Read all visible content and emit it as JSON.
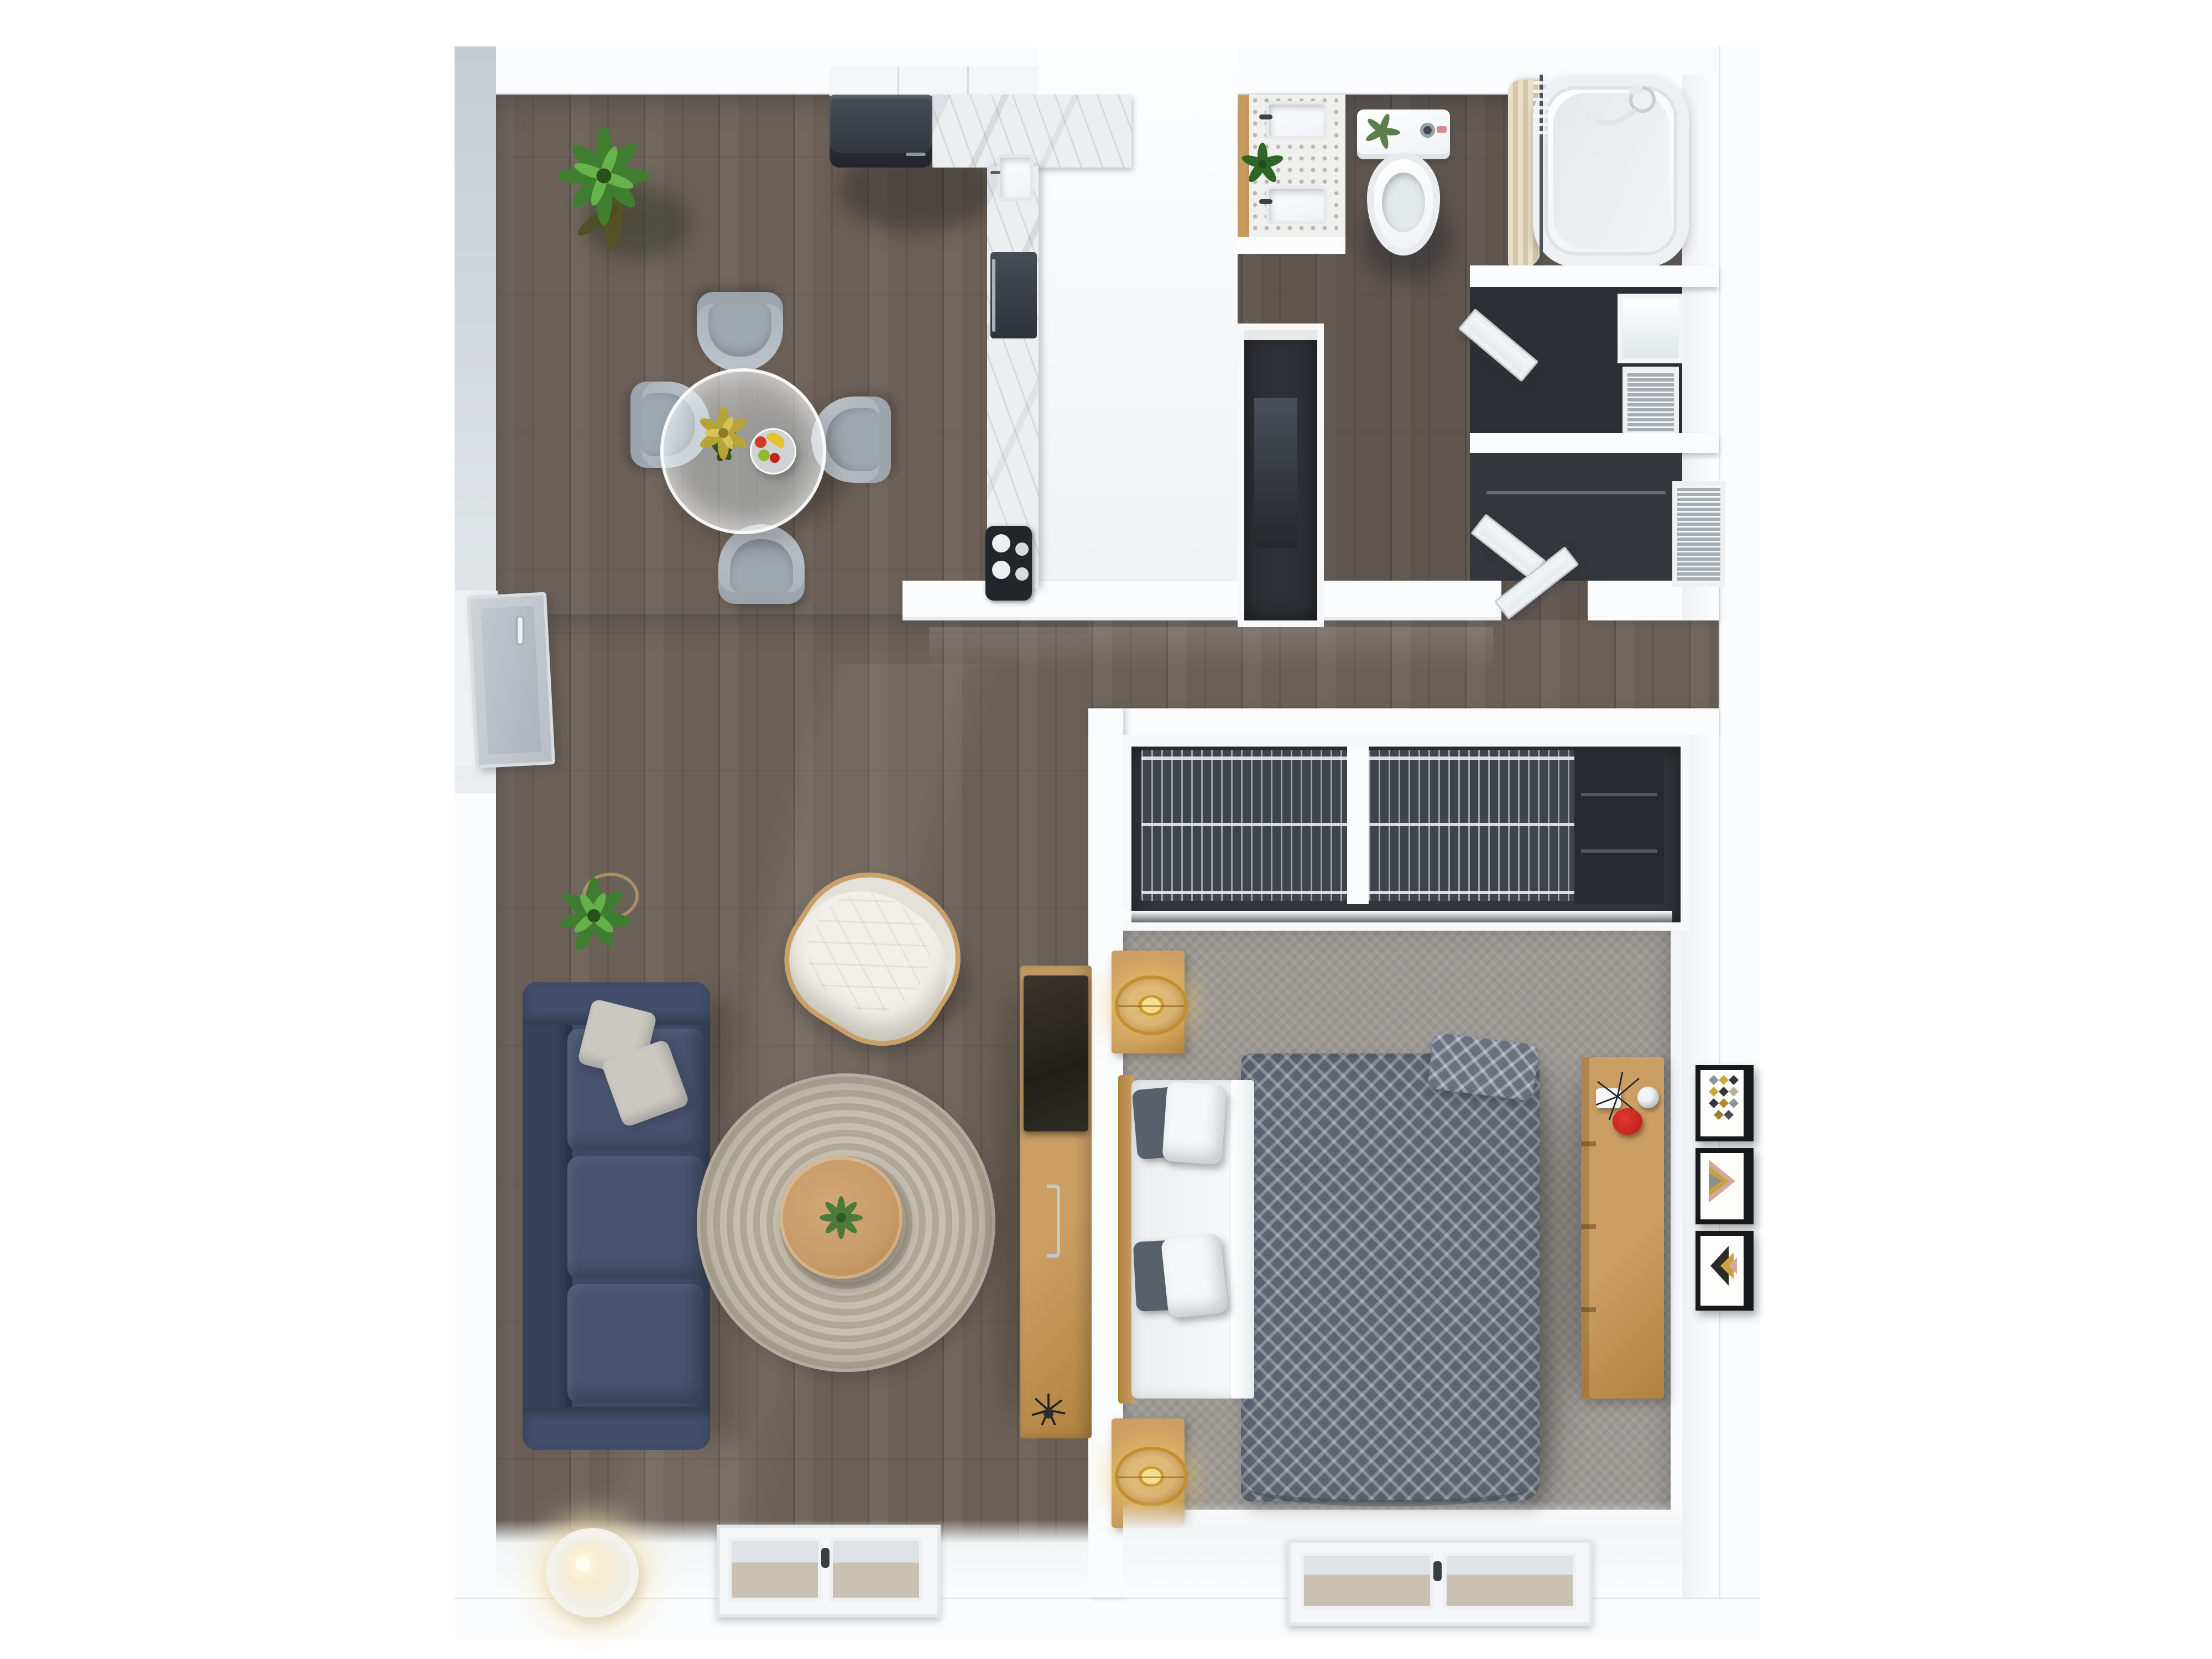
{
  "scene": {
    "type": "floor-plan-3d-top-view",
    "description": "Photorealistic top-down 3D render of a one-bedroom apartment floor plan on a white background",
    "background": "#ffffff"
  },
  "colors": {
    "wall": "#fafcfd",
    "wood": "#6b6057",
    "bath-dim": "rgba(28,30,38,0.16)",
    "carpet": "#9c9995",
    "marble": "#eceef0",
    "grid-door": "#3f444b",
    "blinds": "#cdd3d8",
    "glass-ground": "#c9c1b1",
    "navy": "#3e4a63",
    "navy-light": "#47536f",
    "pillow": "#cbc8c2",
    "oak": "#cb9f64",
    "oak-dark": "#b0823f",
    "duvet": "#5e6572",
    "gold": "#d9a43a",
    "red-accent": "#c5251e",
    "rug-light": "#c7bfb0",
    "rug-dark": "#b0a795",
    "table-wood": "#c времени",
    "tablewood": "#c79a67",
    "plant-green": "#4b8a38",
    "plant-dark": "#2e5d24",
    "appliance": "#34383e",
    "white-goods": "#fafbfc",
    "curtain": "#ded3bb",
    "door-gray": "#b6bcc2"
  },
  "rooms": [
    {
      "name": "living-dining",
      "floor": "dark wood planks",
      "items": [
        "large-potted-plant",
        "round-glass-dining-table",
        "dining-chairs x4",
        "flower-vase",
        "fruit-bowl",
        "navy-sofa",
        "throw-pillows x2",
        "small-potted-plant",
        "round-jute-rug",
        "round-wood-coffee-table",
        "white-tufted-armchair",
        "floor-lamp",
        "tv-console-with-tv",
        "window",
        "entry-door"
      ]
    },
    {
      "name": "kitchen",
      "floor": "dark wood planks",
      "items": [
        "upper-cabinets",
        "refrigerator",
        "marble-counter-L",
        "sink",
        "oven",
        "cooktop-4-burners"
      ]
    },
    {
      "name": "bathroom",
      "floor": "dark wood planks (dim)",
      "items": [
        "double-sink-vanity",
        "vanity-plant",
        "toilet-with-plant",
        "bathtub",
        "shower-fixture",
        "shower-curtain",
        "shower-rail"
      ]
    },
    {
      "name": "hall-and-storage",
      "items": [
        "hallway-wall",
        "interior-door",
        "utility-recess",
        "bifold-closet-door x2",
        "shelf-niche",
        "blinds-window x2"
      ]
    },
    {
      "name": "bedroom",
      "floor": "gray carpet",
      "items": [
        "sliding-door-closet",
        "double-bed",
        "duvet-diamond-pattern",
        "pillows x4",
        "nightstand x2",
        "gold-table-lamp x2",
        "oak-dresser",
        "decor-red-dish",
        "decor-white-box",
        "decor-vase",
        "wall-art x3",
        "window"
      ]
    }
  ],
  "wall_art": [
    {
      "position": 1,
      "motif": "diamond grid in gray, yellow, black"
    },
    {
      "position": 2,
      "motif": "layered triangles in pink, yellow, gray"
    },
    {
      "position": 3,
      "motif": "left-pointing arrows in black, yellow, pink"
    }
  ],
  "fixtures_count": {
    "windows": 4,
    "doors": 4,
    "closets": 3,
    "plants": 5
  }
}
